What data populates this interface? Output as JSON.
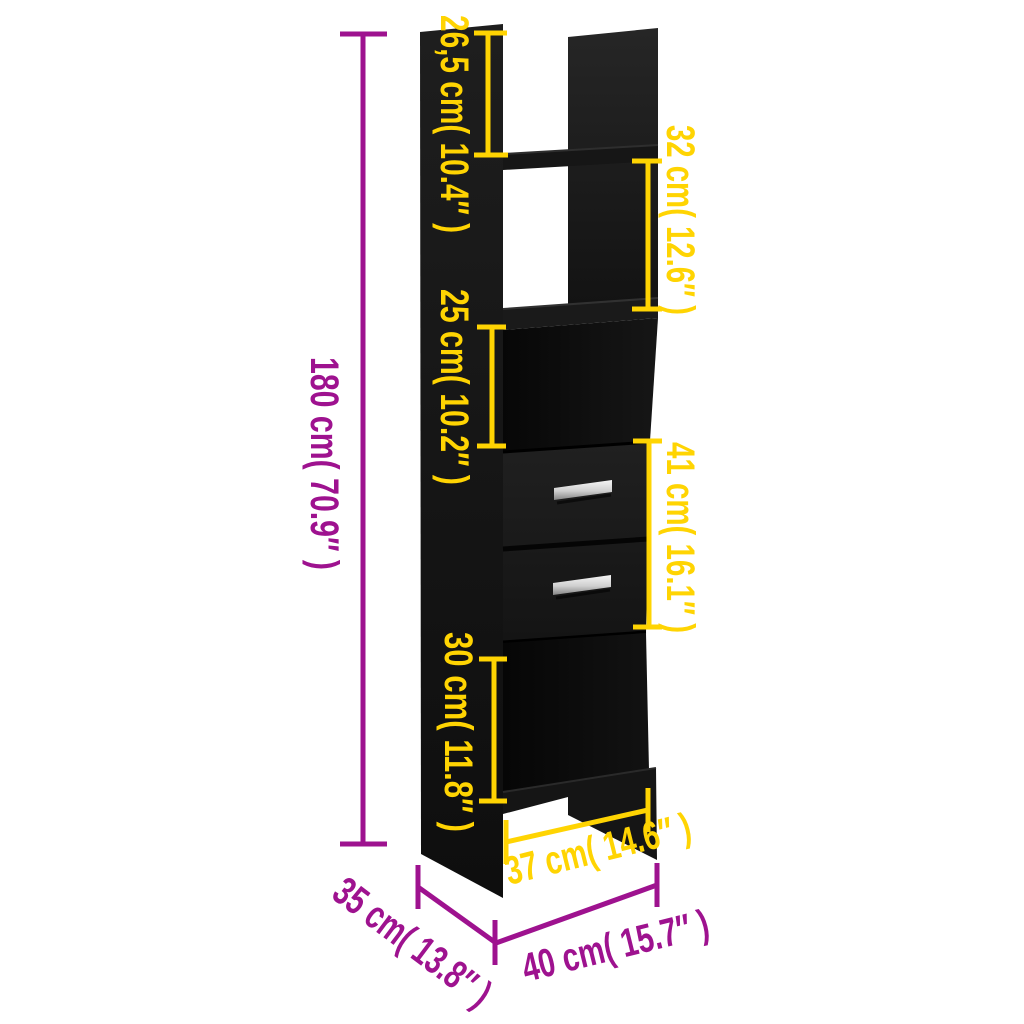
{
  "scene": {
    "background": "#ffffff",
    "subject": "Black book cabinet with five compartments and two drawers, annotated dimension diagram"
  },
  "palette": {
    "outer_dimension_color": "#9e128f",
    "inner_dimension_color": "#ffd402",
    "furniture_color": "#151515",
    "handle_color": "#d8d8d8"
  },
  "dimensions": {
    "overall_height": "180 cm( 70.9″ )",
    "top_compartment_height": "26,5 cm( 10.4″ )",
    "upper_compartment_height": "32 cm( 12.6″ )",
    "middle_compartment_height": "25 cm( 10.2″ )",
    "drawer_section_height": "41 cm( 16.1″ )",
    "lower_compartment_height": "30 cm( 11.8″ )",
    "inner_width": "37 cm( 14.6″ )",
    "depth": "35 cm( 13.8″ )",
    "overall_width": "40 cm( 15.7″ )"
  }
}
